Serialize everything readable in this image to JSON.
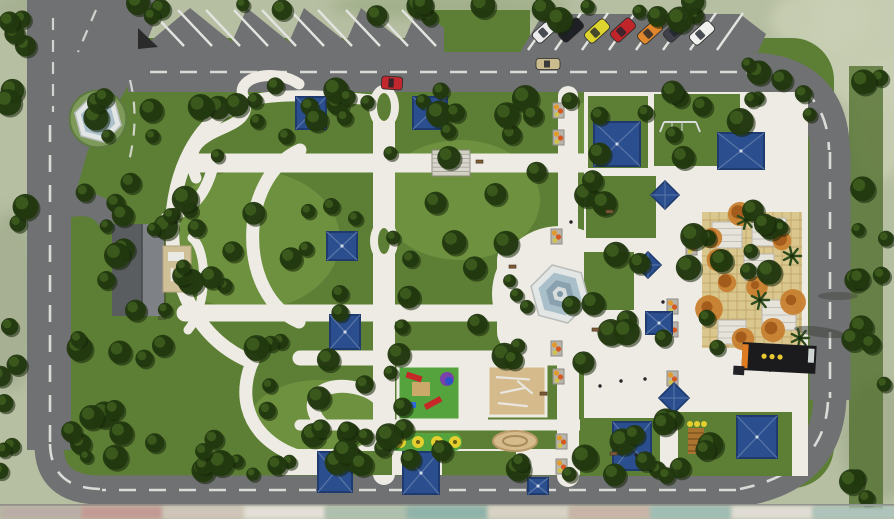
{
  "meta": {
    "title": "Park landscape master plan - aerial top view rendering"
  },
  "palette": {
    "context": "#b7bfa3",
    "context_light": "#c9d0b4",
    "context_dark": "#a3ad8d",
    "grass": "#5d7f35",
    "grass_light": "#6f9340",
    "grass_dark": "#4c6b28",
    "tree": "#22380f",
    "tree_hi": "#3d5c1e",
    "tree_sh": "#15250a",
    "road": "#707172",
    "road_light": "#7d7e7f",
    "marking": "#e3e3df",
    "path": "#edebe3",
    "tent": "#2b4f8e",
    "tent_dark": "#1e3a6e",
    "tent_ridge": "#5a76a8",
    "fountain_rim": "#e2e6e4",
    "water": "#a9bfca",
    "water_dark": "#8aa2b0",
    "paving": "#dac78d",
    "paving_line": "#bb9e63",
    "rubber": "#55a33c",
    "sand": "#d5bb8c",
    "kiosk": "#1b1b1e",
    "kiosk_accent": "#df7b20",
    "kiosk_dot": "#e9c832",
    "roof": "#595d60",
    "roof_light": "#7e8286",
    "annex": "#cfc098",
    "flower1": "#e29a2b",
    "flower2": "#d4581f",
    "flower3": "#cdc24d",
    "autumn1": "#c87f2f",
    "autumn2": "#a45c1d",
    "bench": "#7a5a36",
    "figure": "#26262a",
    "slide_red": "#c62828",
    "dome_blue": "#2b51c9",
    "dome_purple": "#7a3fa8",
    "spring_yellow": "#e3cf2e",
    "trellis": "#d8d6cc"
  },
  "parking": {
    "left_stripes": 10,
    "right_stalls": 8,
    "cars": [
      {
        "color": "#ececec"
      },
      {
        "color": "#1f1f26"
      },
      {
        "color": "#dcd32f"
      },
      {
        "color": "#c0252a"
      },
      {
        "color": "#e0862c"
      },
      {
        "color": "#40404a"
      },
      {
        "color": "#f0f0ee"
      }
    ],
    "moving_cars": [
      {
        "color": "#cbbc8e",
        "x": 548,
        "y": 64,
        "rot": 0,
        "len": 24,
        "wid": 11
      },
      {
        "color": "#c1272d",
        "x": 392,
        "y": 83,
        "rot": 4,
        "len": 21,
        "wid": 13
      }
    ]
  },
  "tents": {
    "square": [
      [
        296,
        97,
        30,
        32
      ],
      [
        413,
        97,
        34,
        32
      ],
      [
        327,
        232,
        30,
        28
      ],
      [
        330,
        315,
        30,
        34
      ],
      [
        594,
        122,
        46,
        44
      ],
      [
        718,
        133,
        46,
        36
      ],
      [
        646,
        312,
        26,
        22
      ],
      [
        613,
        422,
        38,
        48
      ],
      [
        737,
        416,
        40,
        42
      ],
      [
        318,
        452,
        34,
        40
      ],
      [
        403,
        452,
        36,
        42
      ],
      [
        528,
        478,
        20,
        16
      ]
    ],
    "pyramid": [
      [
        665,
        195,
        28
      ],
      [
        648,
        265,
        26
      ],
      [
        674,
        398,
        30
      ]
    ]
  },
  "planters": [
    [
      553,
      103
    ],
    [
      553,
      130
    ],
    [
      551,
      229
    ],
    [
      551,
      341
    ],
    [
      553,
      369
    ],
    [
      556,
      434
    ],
    [
      556,
      459
    ],
    [
      667,
      299
    ],
    [
      667,
      322
    ],
    [
      667,
      371
    ],
    [
      686,
      240
    ]
  ],
  "benches": [
    [
      509,
      265
    ],
    [
      592,
      328
    ],
    [
      540,
      392
    ],
    [
      610,
      452
    ],
    [
      476,
      160
    ],
    [
      606,
      210
    ]
  ],
  "people": [
    [
      600,
      386
    ],
    [
      621,
      381
    ],
    [
      645,
      379
    ],
    [
      663,
      302
    ],
    [
      571,
      222
    ],
    [
      636,
      455
    ]
  ],
  "trees": {
    "clusters": [
      [
        150,
        84,
        600,
        38,
        26
      ],
      [
        420,
        0,
        320,
        20,
        10
      ],
      [
        135,
        0,
        290,
        24,
        8
      ],
      [
        0,
        6,
        28,
        470,
        16
      ],
      [
        68,
        96,
        64,
        370,
        18
      ],
      [
        95,
        428,
        620,
        48,
        26
      ],
      [
        845,
        70,
        42,
        430,
        16
      ],
      [
        140,
        105,
        225,
        255,
        26
      ],
      [
        250,
        330,
        170,
        135,
        12
      ],
      [
        390,
        96,
        200,
        268,
        20
      ],
      [
        492,
        226,
        150,
        150,
        8
      ],
      [
        580,
        92,
        235,
        380,
        16
      ],
      [
        95,
        195,
        115,
        135,
        9
      ],
      [
        735,
        55,
        115,
        70,
        8
      ],
      [
        560,
        418,
        150,
        58,
        8
      ],
      [
        700,
        205,
        105,
        145,
        10
      ]
    ]
  },
  "palms": [
    [
      760,
      300
    ],
    [
      792,
      256
    ],
    [
      746,
      220
    ],
    [
      800,
      338
    ],
    [
      772,
      362
    ]
  ],
  "autumn_trees": [
    [
      712,
      238
    ],
    [
      740,
      214
    ],
    [
      727,
      283
    ],
    [
      757,
      287
    ],
    [
      782,
      241
    ],
    [
      709,
      309
    ],
    [
      743,
      339
    ],
    [
      773,
      330
    ],
    [
      793,
      302
    ],
    [
      718,
      260
    ]
  ],
  "pergola_garden": {
    "x": 702,
    "y": 212,
    "w": 100,
    "h": 136,
    "pergolas": [
      [
        712,
        222,
        30,
        26
      ],
      [
        752,
        218,
        34,
        28
      ],
      [
        762,
        300,
        34,
        30
      ],
      [
        718,
        320,
        28,
        24
      ],
      [
        744,
        254,
        30,
        26
      ]
    ]
  },
  "playground": {
    "rubber": [
      398,
      366,
      62,
      54
    ],
    "sand": [
      488,
      366,
      58,
      50
    ],
    "springs": [
      390,
      433,
      72,
      18
    ],
    "spring_xs": [
      400,
      418,
      437,
      455
    ],
    "logring": [
      515,
      441
    ],
    "climber": [
      688,
      424
    ]
  },
  "fountains": {
    "roundabout": {
      "cx": 98,
      "cy": 119,
      "r": 24
    },
    "central": {
      "cx": 560,
      "cy": 294,
      "r": 30
    }
  },
  "buildings": {
    "service": {
      "x": 112,
      "y": 224
    },
    "kiosk": {
      "x": 742,
      "y": 344,
      "w": 74,
      "h": 28
    }
  },
  "elevation_strip": [
    "#b9aea6",
    "#c49a94",
    "#cfc5b8",
    "#e3e0d8",
    "#aebfae",
    "#8fb3ab",
    "#d8d2c6",
    "#c9b4a8",
    "#9fbdb5",
    "#e0ddd4",
    "#adc3bb"
  ]
}
